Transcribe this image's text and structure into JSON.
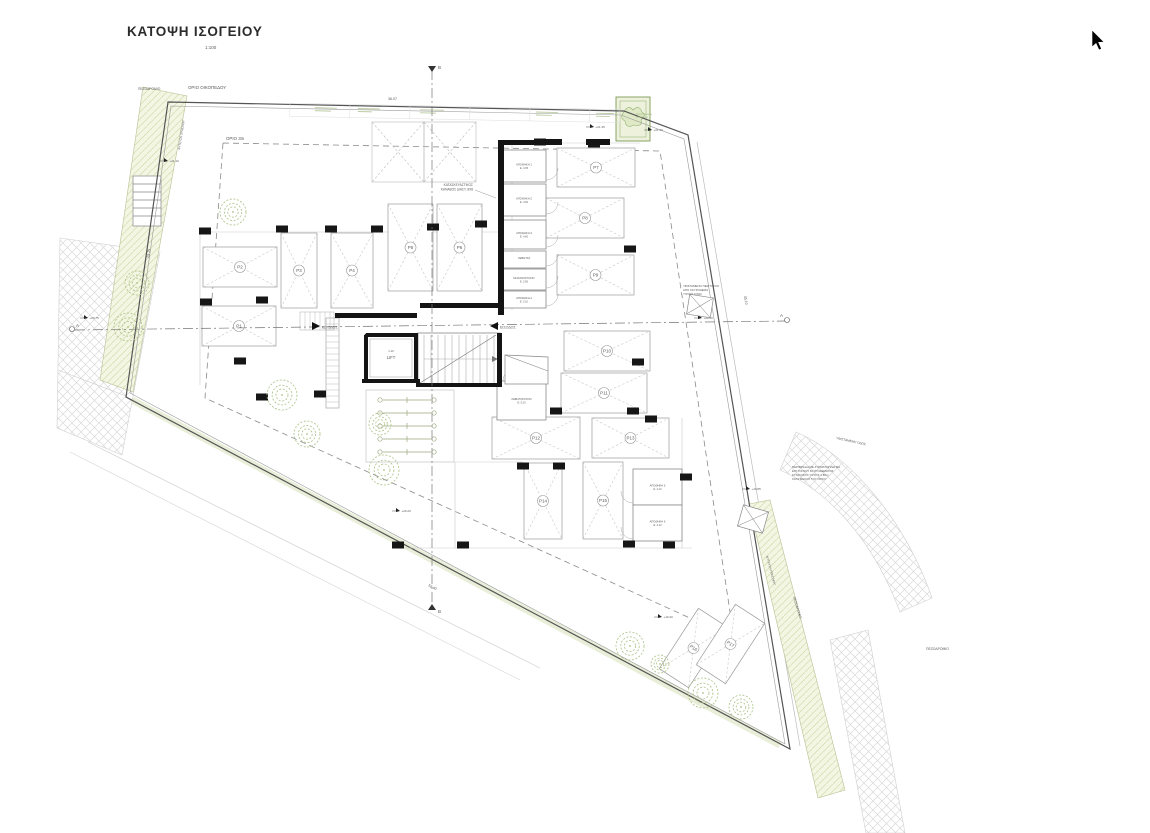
{
  "title": {
    "text": "ΚΑΤΟΨΗ ΙΣΟΓΕΙΟΥ",
    "scale": "1:100"
  },
  "labels": {
    "plot_boundary": "ΟΡΙΟ ΟΙΚΟΠΕΔΟΥ",
    "setback": "ΟΡΙΟ 3m",
    "sidewalk_top": "ΠΕΖΟΔΡΟΜΙΟ",
    "sidewalk_right": "ΠΕΖΟΔΡΟΜΙΟ",
    "sidewalk_right2": "ΠΕΖΟΔΡΟΜΙΟ",
    "existing_road": "ΥΦΙΣΤΑΜΕΝΗ ΟΔΟΣ",
    "planting_left": "ΦΥΤΕΥΣΗ ΠΡΑΣΙΝΟΥ",
    "planting_right": "ΦΥΤΕΥΣΗ ΠΡΑΣΙΝΟΥ",
    "entrance_left": "ΕΙΣΟΔΟΣ",
    "entrance_right": "ΕΙΣΟΔΟΣ",
    "lift": "LIFT",
    "lift_dim": "1.10",
    "grid_note1": "ΚΑΤΑΣΚΕΥΑΣΤΙΚΟΣ",
    "grid_note2": "ΚΑΝΑΒΟΣ ΔΙΑΣΤ. 8Χ8",
    "section_a": "Α",
    "section_b": "Β"
  },
  "notes": {
    "wall_note": [
      "ΥΦΙΣΤΑΜΕΝΟ ΠΕΡΙΤΟΙΧΙΟ",
      "ΑΠΟ ΣΚΥΡΟΔΕΜΑ",
      "ΥΨΟΥΣ 0.50m"
    ],
    "fence_note": [
      "ΠΕΡΙΦΡΑΞΗ ΜΕ ΣΥΡΜΑΤΟΠΛΕΓΜΑ",
      "ΕΠΙ ΤΟΙΧΙΟΥ ΣΚΥΡΟΔΕΜΑΤΟΣ",
      "ΣΥΝΟΛΙΚΟΥ ΥΨΟΥΣ 1.80m",
      "ΚΑΤΑ ΜΗΚΟΣ ΤΟΥ ΟΡΙΟΥ"
    ]
  },
  "dimensions": {
    "top": "36.07",
    "right": "45.10",
    "bottom": "52.40",
    "left": "29.15"
  },
  "elevations": [
    {
      "x": 594,
      "y": 127,
      "v": "+21.35"
    },
    {
      "x": 652,
      "y": 130,
      "v": "+21.30"
    },
    {
      "x": 168,
      "y": 161,
      "v": "+21.10"
    },
    {
      "x": 88,
      "y": 318,
      "v": "+20.75"
    },
    {
      "x": 702,
      "y": 318,
      "v": "+20.60"
    },
    {
      "x": 750,
      "y": 489,
      "v": "+19.85"
    },
    {
      "x": 662,
      "y": 617,
      "v": "+19.40"
    },
    {
      "x": 400,
      "y": 511,
      "v": "+20.20"
    }
  ],
  "parking": {
    "spaces": [
      {
        "label": "P1",
        "x": 202,
        "y": 306,
        "w": 74,
        "h": 40,
        "angle": 0
      },
      {
        "label": "P2",
        "x": 203,
        "y": 247,
        "w": 74,
        "h": 40,
        "angle": 0
      },
      {
        "label": "P3",
        "x": 281,
        "y": 233,
        "w": 36,
        "h": 75,
        "angle": 0
      },
      {
        "label": "P4",
        "x": 331,
        "y": 233,
        "w": 42,
        "h": 75,
        "angle": 0
      },
      {
        "label": "P5",
        "x": 388,
        "y": 204,
        "w": 45,
        "h": 87,
        "angle": 0
      },
      {
        "label": "P6",
        "x": 437,
        "y": 204,
        "w": 45,
        "h": 87,
        "angle": 0
      },
      {
        "label": "P7",
        "x": 557,
        "y": 148,
        "w": 78,
        "h": 39,
        "angle": 0
      },
      {
        "label": "P8",
        "x": 546,
        "y": 198,
        "w": 78,
        "h": 40,
        "angle": 0
      },
      {
        "label": "P9",
        "x": 557,
        "y": 255,
        "w": 77,
        "h": 40,
        "angle": 0
      },
      {
        "label": "P10",
        "x": 564,
        "y": 331,
        "w": 86,
        "h": 40,
        "angle": 0
      },
      {
        "label": "P11",
        "x": 561,
        "y": 373,
        "w": 86,
        "h": 40,
        "angle": 0
      },
      {
        "label": "P12",
        "x": 492,
        "y": 417,
        "w": 88,
        "h": 42,
        "angle": 0
      },
      {
        "label": "P13",
        "x": 592,
        "y": 418,
        "w": 77,
        "h": 40,
        "angle": 0
      },
      {
        "label": "P14",
        "x": 524,
        "y": 463,
        "w": 38,
        "h": 76,
        "angle": 0
      },
      {
        "label": "P15",
        "x": 583,
        "y": 462,
        "w": 40,
        "h": 77,
        "angle": 0
      },
      {
        "label": "P16",
        "x": 676,
        "y": 612,
        "w": 35,
        "h": 72,
        "angle": 33
      },
      {
        "label": "P17",
        "x": 713,
        "y": 608,
        "w": 35,
        "h": 72,
        "angle": 33
      }
    ]
  },
  "rooms": [
    {
      "label": "ΑΠΟΘΗΚΗ 1",
      "area": "Ε: 4.35",
      "x": 502,
      "y": 150,
      "w": 44,
      "h": 32,
      "door": "r"
    },
    {
      "label": "ΑΠΟΘΗΚΗ 2",
      "area": "Ε: 4.60",
      "x": 502,
      "y": 184,
      "w": 44,
      "h": 32,
      "door": "r"
    },
    {
      "label": "ΑΠΟΘΗΚΗ 3",
      "area": "Ε: 4.60",
      "x": 502,
      "y": 220,
      "w": 44,
      "h": 29,
      "door": "r"
    },
    {
      "label": "ΛΕΒΗΤΑΣ",
      "area": "",
      "x": 502,
      "y": 251,
      "w": 44,
      "h": 17,
      "door": "r"
    },
    {
      "label": "ΜΗΧΑΝΟΣΤΑΣΙΟ",
      "area": "Ε: 2.90",
      "x": 502,
      "y": 269,
      "w": 44,
      "h": 21,
      "door": "r"
    },
    {
      "label": "ΑΠΟΘΗΚΗ 4",
      "area": "Ε: 2.10",
      "x": 502,
      "y": 291,
      "w": 44,
      "h": 17,
      "door": "r"
    },
    {
      "label": "ΛΕΒΗΤΟΣΤΑΣΙΟ",
      "area": "Ε: 5.20",
      "x": 497,
      "y": 381,
      "w": 49,
      "h": 39,
      "door": "t"
    },
    {
      "label": "ΑΠΟΘΗΚΗ 5",
      "area": "Ε: 4.10",
      "x": 633,
      "y": 469,
      "w": 49,
      "h": 36,
      "door": "l"
    },
    {
      "label": "ΑΠΟΘΗΚΗ 6",
      "area": "Ε: 4.10",
      "x": 633,
      "y": 505,
      "w": 49,
      "h": 36,
      "door": "l"
    }
  ],
  "structure": {
    "columns": [
      [
        205,
        231
      ],
      [
        282,
        229
      ],
      [
        331,
        229
      ],
      [
        377,
        229
      ],
      [
        433,
        227
      ],
      [
        481,
        224
      ],
      [
        206,
        302
      ],
      [
        262,
        300
      ],
      [
        240,
        361
      ],
      [
        320,
        394
      ],
      [
        262,
        397
      ],
      [
        540,
        142
      ],
      [
        594,
        144
      ],
      [
        630,
        249
      ],
      [
        638,
        362
      ],
      [
        651,
        419
      ],
      [
        523,
        466
      ],
      [
        559,
        466
      ],
      [
        398,
        545
      ],
      [
        463,
        545
      ],
      [
        629,
        544
      ],
      [
        669,
        545
      ],
      [
        556,
        411
      ],
      [
        633,
        411
      ],
      [
        686,
        477
      ]
    ],
    "bars": [
      [
        335,
        313,
        82,
        5
      ],
      [
        420,
        303,
        83,
        5
      ],
      [
        498,
        144,
        6,
        171
      ],
      [
        498,
        140,
        50,
        5
      ],
      [
        366,
        333,
        52,
        4
      ],
      [
        362,
        379,
        58,
        4
      ],
      [
        414,
        335,
        4,
        47
      ],
      [
        364,
        335,
        4,
        47
      ],
      [
        497,
        333,
        5,
        52
      ],
      [
        416,
        383,
        86,
        4
      ],
      [
        586,
        139,
        24,
        6
      ],
      [
        538,
        139,
        24,
        6
      ]
    ]
  },
  "trees": [
    [
      233,
      212,
      13
    ],
    [
      137,
      283,
      12
    ],
    [
      128,
      327,
      14
    ],
    [
      282,
      395,
      15
    ],
    [
      307,
      434,
      13
    ],
    [
      380,
      424,
      11
    ],
    [
      384,
      470,
      15
    ],
    [
      630,
      646,
      14
    ],
    [
      703,
      693,
      15
    ],
    [
      741,
      707,
      12
    ],
    [
      660,
      664,
      9
    ]
  ],
  "bikes": {
    "count": 5
  },
  "colors": {
    "line": "#6e6e6e",
    "wall": "#141414",
    "green_fill": "#f4f6e4",
    "green_line": "#c6cf9f",
    "tree": "#a9c184",
    "road_hatch": "#d6d6d6",
    "dash": "#8a8a8a",
    "text": "#5a5a5a"
  }
}
